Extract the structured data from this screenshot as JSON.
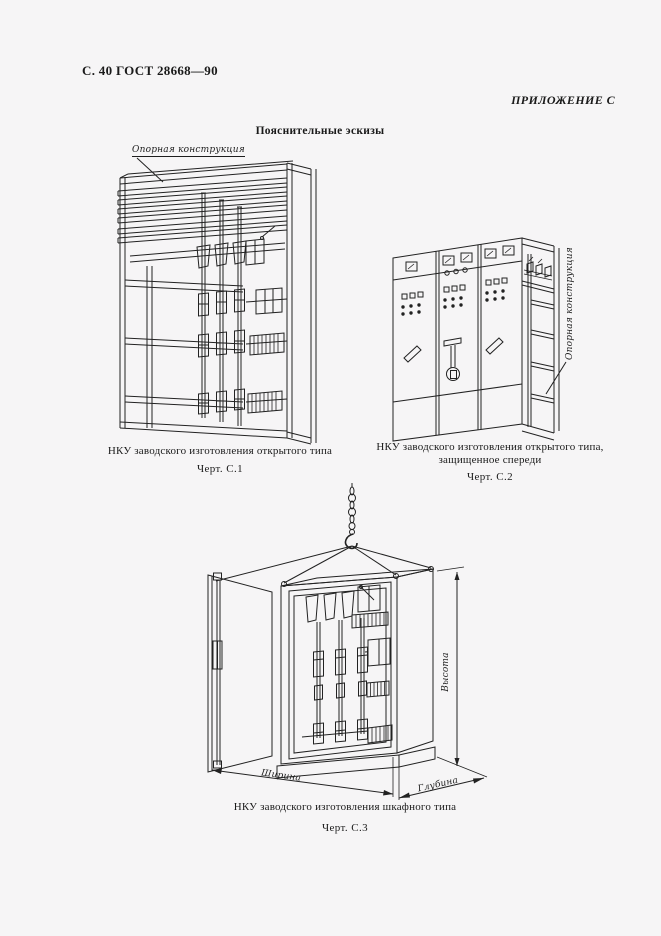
{
  "document": {
    "page_header": "С. 40 ГОСТ 28668—90",
    "annex_label": "ПРИЛОЖЕНИЕ С",
    "section_title": "Пояснительные эскизы"
  },
  "figures": {
    "c1": {
      "callout": "Опорная конструкция",
      "caption": "НКУ заводского изготовления открытого типа",
      "figure_number": "Черт. С.1"
    },
    "c2": {
      "callout": "Опорная конструкция",
      "caption_line1": "НКУ заводского изготовления открытого типа,",
      "caption_line2": "защищенное спереди",
      "figure_number": "Черт. С.2"
    },
    "c3": {
      "caption": "НКУ заводского изготовления шкафного типа",
      "figure_number": "Черт. С.3",
      "dim_height": "Высота",
      "dim_width": "Ширина",
      "dim_depth": "Глубина"
    }
  },
  "colors": {
    "ink": "#1e1e1e",
    "paper": "#f6f5f6"
  }
}
